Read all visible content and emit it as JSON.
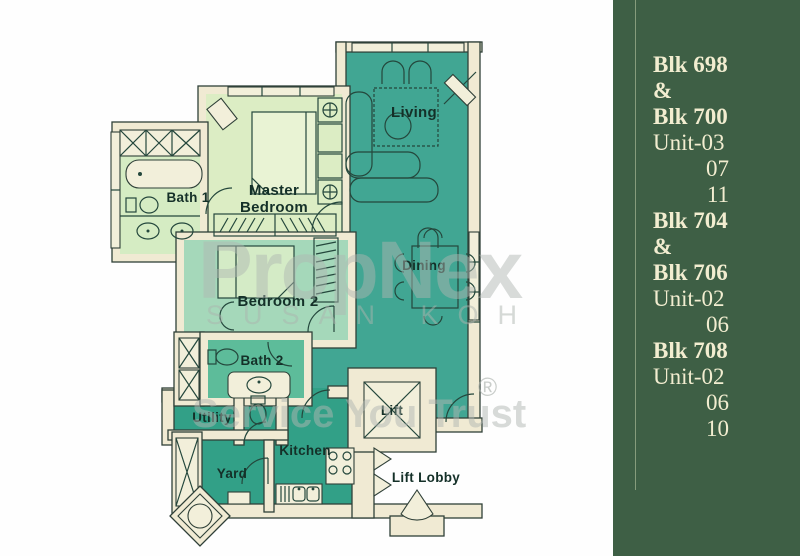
{
  "panel": {
    "bg_color": "#3e5f45",
    "text_color": "#f2edd0",
    "divider_color": "#9fb08f",
    "lines": [
      {
        "text": "Blk 698",
        "kind": "blk"
      },
      {
        "text": "&",
        "kind": "amp"
      },
      {
        "text": "Blk 700",
        "kind": "blk"
      },
      {
        "text": "Unit-03",
        "kind": "unit"
      },
      {
        "text": "07",
        "kind": "num"
      },
      {
        "text": "11",
        "kind": "num"
      },
      {
        "text": "Blk 704",
        "kind": "blk"
      },
      {
        "text": "&",
        "kind": "amp"
      },
      {
        "text": "Blk 706",
        "kind": "blk"
      },
      {
        "text": "Unit-02",
        "kind": "unit"
      },
      {
        "text": "06",
        "kind": "num"
      },
      {
        "text": "Blk 708",
        "kind": "blk"
      },
      {
        "text": "Unit-02",
        "kind": "unit"
      },
      {
        "text": "06",
        "kind": "num"
      },
      {
        "text": "10",
        "kind": "num"
      }
    ]
  },
  "floorplan": {
    "labels": {
      "living": "Living",
      "master_lines": [
        "Master",
        "Bedroom"
      ],
      "bath1": "Bath 1",
      "dining": "Dining",
      "bedroom2": "Bedroom 2",
      "bath2": "Bath 2",
      "utility": "Utility",
      "kitchen": "Kitchen",
      "yard": "Yard",
      "lift": "Lift",
      "lift_lobby": "Lift Lobby"
    },
    "colors": {
      "living_dining_teal": "#41a693",
      "service_teal": "#32a087",
      "master_bedroom": "#dcedc4",
      "bath1": "#d5ecc3",
      "bedroom2": "#a5d8ba",
      "bath2": "#5dbc9a",
      "wall_cream": "#f0ead3",
      "outline": "#2f4038",
      "label_text": "#143028"
    }
  },
  "watermark": {
    "brand": "PropNex",
    "registered": "®",
    "agent_name": "SUSAN KOH",
    "slogan": "Service You Trust"
  }
}
